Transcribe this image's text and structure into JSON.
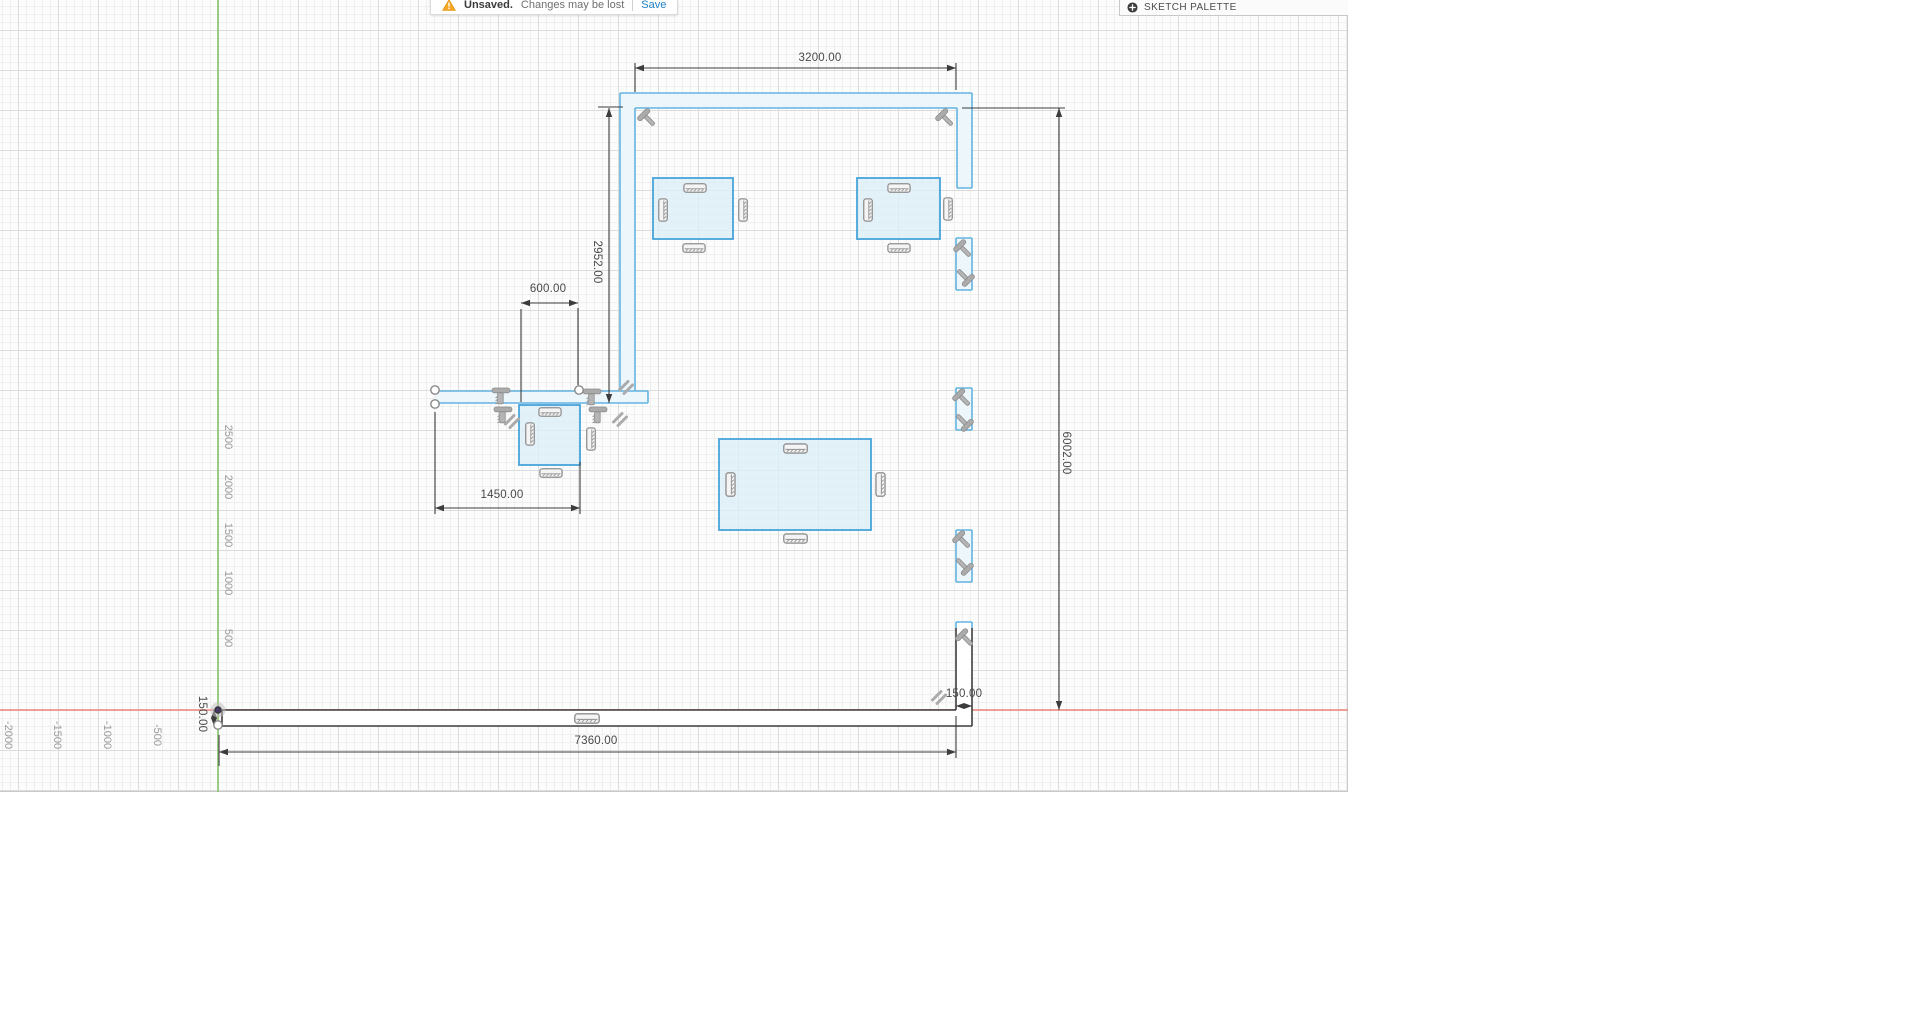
{
  "toolbar": {
    "warning_label": "Unsaved.",
    "message": "Changes may be lost",
    "save_label": "Save"
  },
  "sketch_palette": {
    "title": "SKETCH PALETTE"
  },
  "dimensions": {
    "top_opening_width": "3200.00",
    "left_wall_height": "2952.00",
    "small_opening_width": "600.00",
    "lower_wall_width": "1450.00",
    "right_wall_height": "6002.00",
    "bottom_wall_width": "7360.00",
    "right_wall_thickness": "150.00",
    "bottom_wall_thickness": "150.00"
  },
  "axes": {
    "y_labels": [
      "2500",
      "2000",
      "1500",
      "1000",
      "500"
    ],
    "x_labels": [
      "-2000",
      "-1500",
      "-1000",
      "-500"
    ]
  },
  "icons": {
    "warning": "warning-triangle",
    "palette_toggle": "circle-plus",
    "constraint_fix": "hammer-glyph",
    "constraint_perpendicular": "perpendicular-glyph",
    "constraint_parallel": "parallel-glyph",
    "furniture": "chair-glyph"
  },
  "colors": {
    "sketch_blue": "#47a4da",
    "wall_blue": "#63b4e2",
    "table_fill": "#dcedf8",
    "wall_fill": "#edf6fb",
    "constrained_black": "#3e3e3e",
    "dimension": "#3c3c3c",
    "axis_x_red": "#ec9287",
    "axis_y_green": "#8cc671",
    "save_link": "#1f7ec4"
  }
}
